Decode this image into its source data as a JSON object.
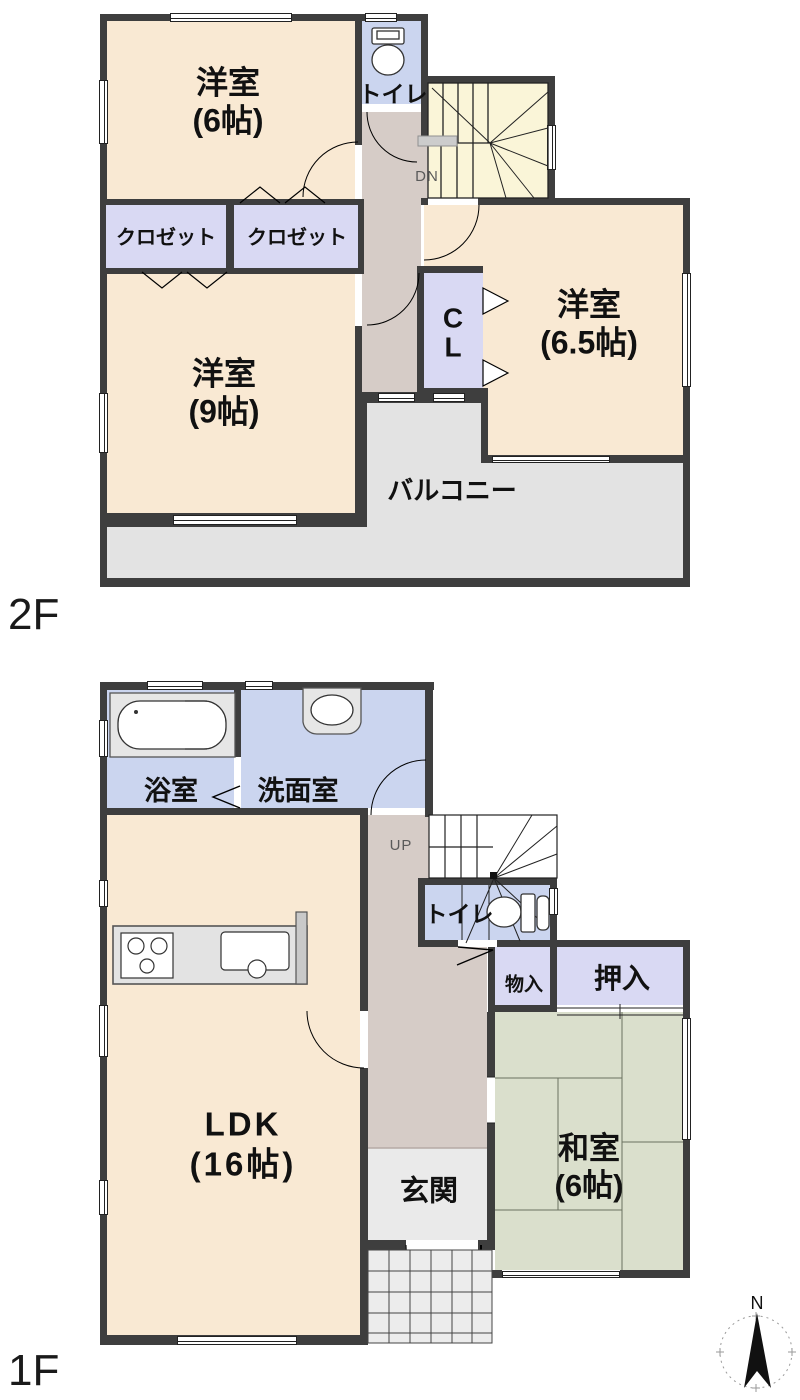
{
  "floor2": {
    "floor_label": "2F",
    "rooms": {
      "yoshitsu6": "洋室\n(6帖)",
      "toilet": "トイレ",
      "closet_a": "クロゼット",
      "closet_b": "クロゼット",
      "yoshitsu9": "洋室\n(9帖)",
      "cl": "C\nL",
      "yoshitsu65": "洋室\n(6.5帖)",
      "balcony": "バルコニー",
      "stair_dir": "DN"
    }
  },
  "floor1": {
    "floor_label": "1F",
    "rooms": {
      "bath": "浴室",
      "washroom": "洗面室",
      "stair_dir": "UP",
      "toilet": "トイレ",
      "storage": "物入",
      "oshiire": "押入",
      "ldk": "LDK\n(16帖)",
      "genkan": "玄関",
      "washitsu": "和室\n(6帖)"
    }
  },
  "compass": {
    "north_label": "N"
  },
  "colors": {
    "wall": "#3e3e3e",
    "room_beige": "#F9E9D3",
    "water_blue": "#CBD5EF",
    "closet_lavender": "#D9D9F3",
    "stairs_yellow": "#FAF5D8",
    "hall_gray": "#D6CCC7",
    "balcony_gray": "#E3E3E3",
    "genkan_gray": "#EAEAEA",
    "porch_gray": "#ECECEC",
    "tatami_green": "#DADFCC"
  }
}
